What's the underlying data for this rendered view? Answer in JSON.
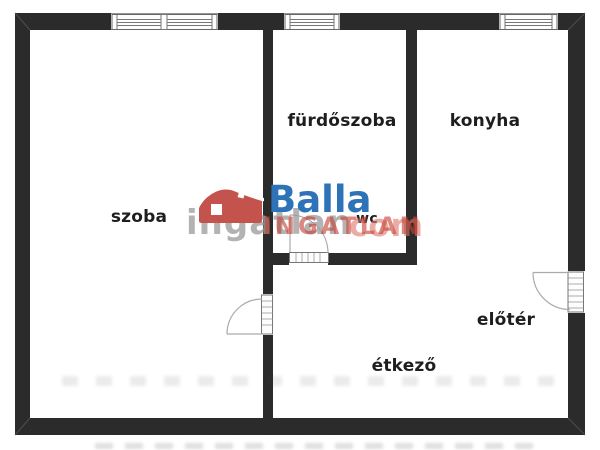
{
  "floorplan": {
    "type": "apartment floor plan",
    "wall_color": "#2b2b2b",
    "rooms": [
      {
        "name": "szoba"
      },
      {
        "name": "fürdőszoba"
      },
      {
        "name": "konyha"
      },
      {
        "name": "wc"
      },
      {
        "name": "előtér"
      },
      {
        "name": "étkező"
      }
    ]
  },
  "watermark": {
    "brand": "Balla",
    "brand_caps": "INGATLAN",
    "portal_gray": "ingatlan",
    "portal_suffix": "com",
    "colors": {
      "brand_blue": "#2e73b8",
      "brand_red": "#c64234",
      "house_red": "#c4534e",
      "portal_gray": "#9e9e9e"
    }
  }
}
